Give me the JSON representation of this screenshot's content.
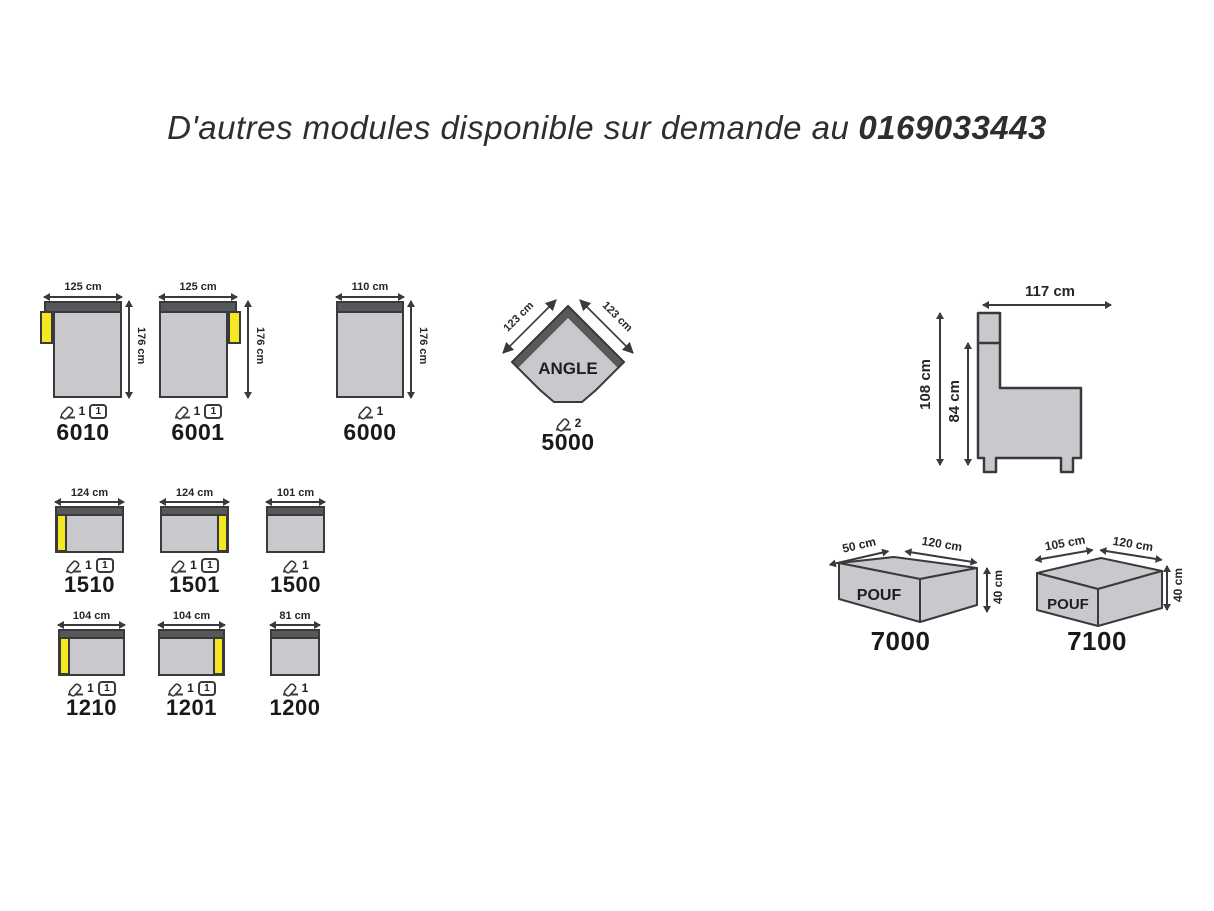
{
  "title": {
    "prefix": "D'autres modules disponible sur demande au",
    "phone": "0169033443"
  },
  "colors": {
    "backrest_dark_gray": "#57585a",
    "seat_light_gray": "#c9c8cc",
    "armrest_yellow": "#f3e822",
    "outline": "#3a3a3c"
  },
  "modules": {
    "m6010": {
      "id": "6010",
      "width": "125 cm",
      "height": "176 cm",
      "armrest": "left",
      "wedge_count": "1",
      "cushion_count": "1"
    },
    "m6001": {
      "id": "6001",
      "width": "125 cm",
      "height": "176 cm",
      "armrest": "right",
      "wedge_count": "1",
      "cushion_count": "1"
    },
    "m6000": {
      "id": "6000",
      "width": "110 cm",
      "height": "176 cm",
      "armrest": "none",
      "wedge_count": "1"
    },
    "m5000": {
      "id": "5000",
      "name": "ANGLE",
      "side_left": "123 cm",
      "side_right": "123 cm",
      "wedge_count": "2"
    },
    "m1510": {
      "id": "1510",
      "width": "124 cm",
      "armrest": "left",
      "wedge_count": "1",
      "cushion_count": "1"
    },
    "m1501": {
      "id": "1501",
      "width": "124 cm",
      "armrest": "right",
      "wedge_count": "1",
      "cushion_count": "1"
    },
    "m1500": {
      "id": "1500",
      "width": "101 cm",
      "armrest": "none",
      "wedge_count": "1"
    },
    "m1210": {
      "id": "1210",
      "width": "104 cm",
      "armrest": "left",
      "wedge_count": "1",
      "cushion_count": "1"
    },
    "m1201": {
      "id": "1201",
      "width": "104 cm",
      "armrest": "right",
      "wedge_count": "1",
      "cushion_count": "1"
    },
    "m1200": {
      "id": "1200",
      "width": "81 cm",
      "armrest": "none",
      "wedge_count": "1"
    },
    "m7000": {
      "id": "7000",
      "name": "POUF",
      "depth": "50 cm",
      "width": "120 cm",
      "height": "40 cm"
    },
    "m7100": {
      "id": "7100",
      "name": "POUF",
      "depth": "105 cm",
      "width": "120 cm",
      "height": "40 cm"
    }
  },
  "side_view": {
    "width_label": "117 cm",
    "height_total_label": "108 cm",
    "height_seat_label": "84 cm"
  }
}
